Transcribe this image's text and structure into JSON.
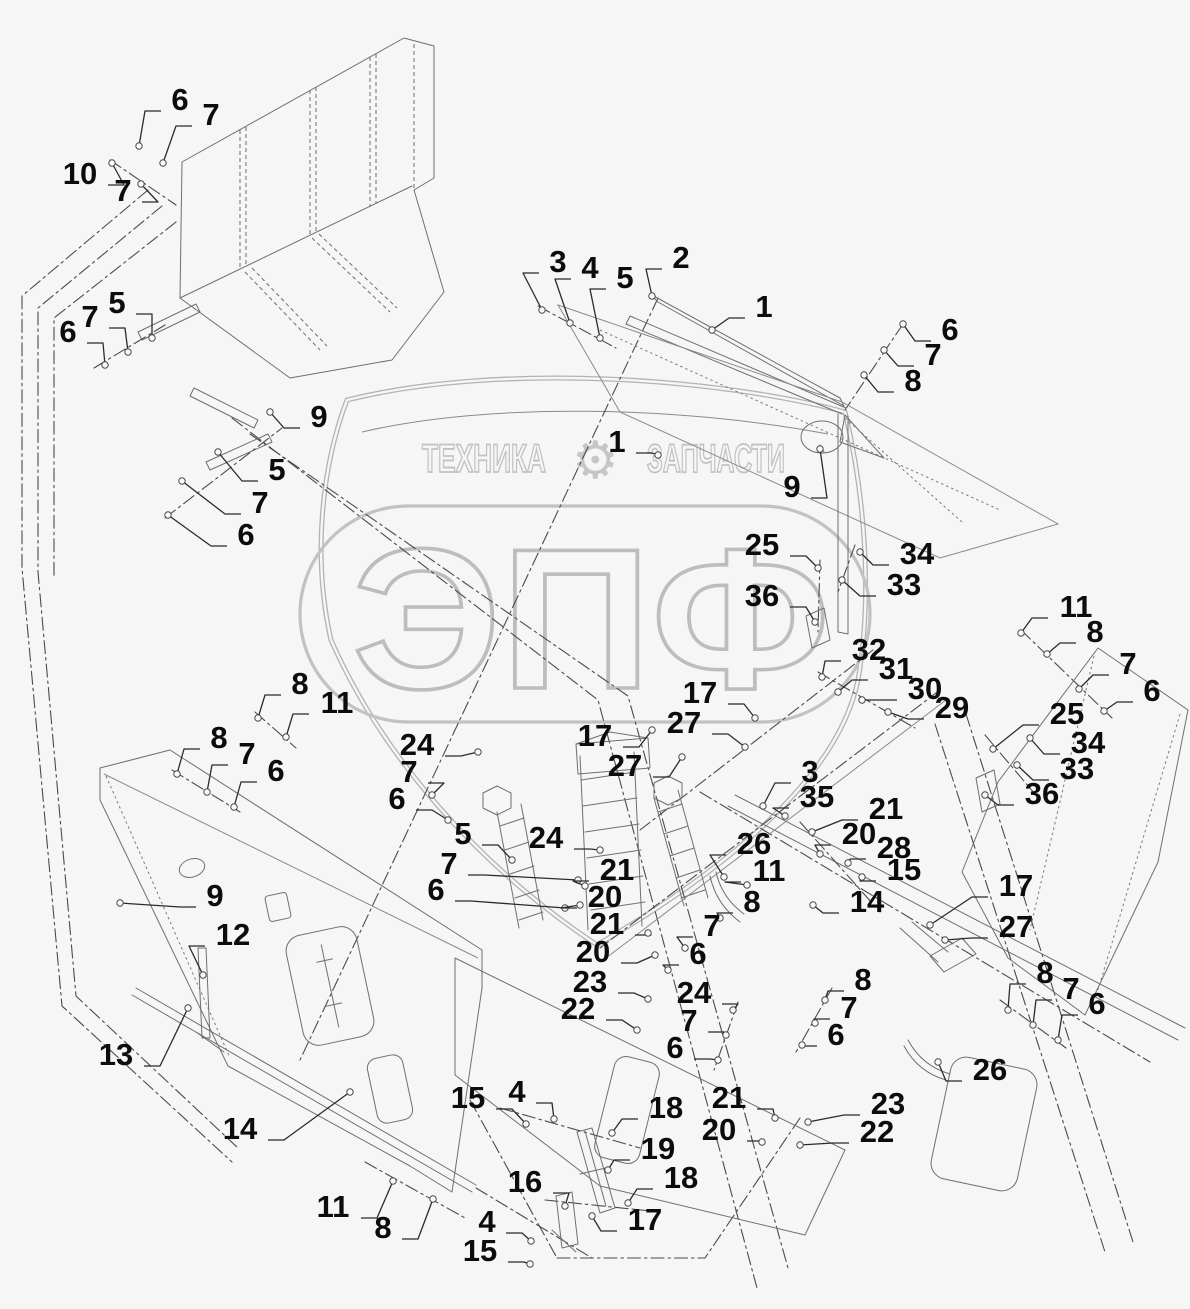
{
  "watermark": {
    "brand_left": "ТЕХНИКА",
    "brand_right": "ЗАПЧАСТИ",
    "gear_icon": "⚙",
    "logo": "ЭПФ",
    "color": "#c2c2c2"
  },
  "colors": {
    "background": "#f6f6f6",
    "line_art": "#6f6f6f",
    "phantom_lines": "#4b4b4b",
    "callout_text": "#0c0c0c",
    "shroud_gray": "#b3b3b3"
  },
  "diagram": {
    "type": "exploded-parts-diagram",
    "part_numbers_shown": [
      "1",
      "2",
      "3",
      "4",
      "5",
      "6",
      "7",
      "8",
      "9",
      "10",
      "11",
      "12",
      "13",
      "14",
      "15",
      "16",
      "17",
      "18",
      "19",
      "20",
      "21",
      "22",
      "23",
      "24",
      "25",
      "26",
      "27",
      "28",
      "29",
      "30",
      "31",
      "32",
      "33",
      "34",
      "35",
      "36"
    ],
    "callouts": [
      {
        "n": "6",
        "x": 180,
        "y": 99,
        "tx": 139,
        "ty": 146
      },
      {
        "n": "7",
        "x": 211,
        "y": 114,
        "tx": 163,
        "ty": 163
      },
      {
        "n": "10",
        "x": 80,
        "y": 173,
        "tx": 112,
        "ty": 163
      },
      {
        "n": "7",
        "x": 123,
        "y": 190,
        "tx": 141,
        "ty": 184
      },
      {
        "n": "6",
        "x": 68,
        "y": 331,
        "tx": 105,
        "ty": 365
      },
      {
        "n": "7",
        "x": 90,
        "y": 316,
        "tx": 128,
        "ty": 352
      },
      {
        "n": "5",
        "x": 117,
        "y": 302,
        "tx": 152,
        "ty": 338
      },
      {
        "n": "9",
        "x": 319,
        "y": 416,
        "tx": 270,
        "ty": 412
      },
      {
        "n": "5",
        "x": 277,
        "y": 469,
        "tx": 218,
        "ty": 452
      },
      {
        "n": "7",
        "x": 260,
        "y": 502,
        "tx": 182,
        "ty": 481
      },
      {
        "n": "6",
        "x": 246,
        "y": 534,
        "tx": 168,
        "ty": 515
      },
      {
        "n": "3",
        "x": 558,
        "y": 261,
        "tx": 542,
        "ty": 310
      },
      {
        "n": "4",
        "x": 590,
        "y": 267,
        "tx": 570,
        "ty": 323
      },
      {
        "n": "5",
        "x": 625,
        "y": 277,
        "tx": 600,
        "ty": 338
      },
      {
        "n": "2",
        "x": 681,
        "y": 257,
        "tx": 652,
        "ty": 296
      },
      {
        "n": "1",
        "x": 764,
        "y": 306,
        "tx": 712,
        "ty": 330
      },
      {
        "n": "1",
        "x": 617,
        "y": 441,
        "tx": 658,
        "ty": 455
      },
      {
        "n": "9",
        "x": 792,
        "y": 486,
        "tx": 820,
        "ty": 449
      },
      {
        "n": "6",
        "x": 950,
        "y": 329,
        "tx": 903,
        "ty": 324
      },
      {
        "n": "7",
        "x": 933,
        "y": 354,
        "tx": 884,
        "ty": 350
      },
      {
        "n": "8",
        "x": 913,
        "y": 380,
        "tx": 864,
        "ty": 375
      },
      {
        "n": "25",
        "x": 762,
        "y": 544,
        "tx": 818,
        "ty": 568
      },
      {
        "n": "34",
        "x": 917,
        "y": 553,
        "tx": 860,
        "ty": 552
      },
      {
        "n": "33",
        "x": 904,
        "y": 584,
        "tx": 842,
        "ty": 580
      },
      {
        "n": "36",
        "x": 762,
        "y": 595,
        "tx": 815,
        "ty": 622
      },
      {
        "n": "32",
        "x": 869,
        "y": 649,
        "tx": 822,
        "ty": 677
      },
      {
        "n": "31",
        "x": 896,
        "y": 668,
        "tx": 838,
        "ty": 692
      },
      {
        "n": "30",
        "x": 925,
        "y": 688,
        "tx": 862,
        "ty": 700
      },
      {
        "n": "29",
        "x": 952,
        "y": 707,
        "tx": 888,
        "ty": 712
      },
      {
        "n": "11",
        "x": 1076,
        "y": 606,
        "tx": 1021,
        "ty": 633
      },
      {
        "n": "8",
        "x": 1095,
        "y": 631,
        "tx": 1047,
        "ty": 654
      },
      {
        "n": "7",
        "x": 1128,
        "y": 663,
        "tx": 1079,
        "ty": 689
      },
      {
        "n": "6",
        "x": 1152,
        "y": 690,
        "tx": 1104,
        "ty": 711
      },
      {
        "n": "17",
        "x": 700,
        "y": 692,
        "tx": 755,
        "ty": 718
      },
      {
        "n": "27",
        "x": 684,
        "y": 722,
        "tx": 745,
        "ty": 747
      },
      {
        "n": "17",
        "x": 595,
        "y": 735,
        "tx": 652,
        "ty": 730
      },
      {
        "n": "27",
        "x": 625,
        "y": 765,
        "tx": 682,
        "ty": 757
      },
      {
        "n": "24",
        "x": 417,
        "y": 744,
        "tx": 478,
        "ty": 752
      },
      {
        "n": "7",
        "x": 409,
        "y": 771,
        "tx": 432,
        "ty": 795
      },
      {
        "n": "6",
        "x": 397,
        "y": 798,
        "tx": 448,
        "ty": 820
      },
      {
        "n": "3",
        "x": 810,
        "y": 771,
        "tx": 763,
        "ty": 806
      },
      {
        "n": "35",
        "x": 817,
        "y": 796,
        "tx": 785,
        "ty": 816
      },
      {
        "n": "21",
        "x": 886,
        "y": 808,
        "tx": 812,
        "ty": 832
      },
      {
        "n": "20",
        "x": 859,
        "y": 833,
        "tx": 820,
        "ty": 854
      },
      {
        "n": "28",
        "x": 894,
        "y": 847,
        "tx": 848,
        "ty": 863
      },
      {
        "n": "15",
        "x": 904,
        "y": 869,
        "tx": 862,
        "ty": 877
      },
      {
        "n": "5",
        "x": 463,
        "y": 833,
        "tx": 512,
        "ty": 860
      },
      {
        "n": "7",
        "x": 449,
        "y": 863,
        "tx": 578,
        "ty": 880
      },
      {
        "n": "6",
        "x": 436,
        "y": 889,
        "tx": 565,
        "ty": 908
      },
      {
        "n": "24",
        "x": 546,
        "y": 837,
        "tx": 600,
        "ty": 850
      },
      {
        "n": "26",
        "x": 754,
        "y": 843,
        "tx": 724,
        "ty": 877
      },
      {
        "n": "11",
        "x": 769,
        "y": 870,
        "tx": 747,
        "ty": 885
      },
      {
        "n": "8",
        "x": 752,
        "y": 901,
        "tx": 720,
        "ty": 918
      },
      {
        "n": "14",
        "x": 867,
        "y": 901,
        "tx": 813,
        "ty": 905
      },
      {
        "n": "21",
        "x": 617,
        "y": 869,
        "tx": 585,
        "ty": 886
      },
      {
        "n": "20",
        "x": 605,
        "y": 896,
        "tx": 580,
        "ty": 905
      },
      {
        "n": "21",
        "x": 607,
        "y": 923,
        "tx": 648,
        "ty": 933
      },
      {
        "n": "20",
        "x": 593,
        "y": 951,
        "tx": 655,
        "ty": 955
      },
      {
        "n": "23",
        "x": 590,
        "y": 981,
        "tx": 648,
        "ty": 999
      },
      {
        "n": "22",
        "x": 578,
        "y": 1008,
        "tx": 637,
        "ty": 1030
      },
      {
        "n": "7",
        "x": 712,
        "y": 925,
        "tx": 685,
        "ty": 948
      },
      {
        "n": "6",
        "x": 698,
        "y": 953,
        "tx": 668,
        "ty": 970
      },
      {
        "n": "24",
        "x": 694,
        "y": 992,
        "tx": 733,
        "ty": 1010
      },
      {
        "n": "7",
        "x": 689,
        "y": 1020,
        "tx": 726,
        "ty": 1035
      },
      {
        "n": "6",
        "x": 675,
        "y": 1047,
        "tx": 718,
        "ty": 1060
      },
      {
        "n": "8",
        "x": 863,
        "y": 979,
        "tx": 825,
        "ty": 1000
      },
      {
        "n": "7",
        "x": 849,
        "y": 1007,
        "tx": 815,
        "ty": 1023
      },
      {
        "n": "6",
        "x": 836,
        "y": 1034,
        "tx": 802,
        "ty": 1045
      },
      {
        "n": "17",
        "x": 1016,
        "y": 885,
        "tx": 930,
        "ty": 925
      },
      {
        "n": "27",
        "x": 1016,
        "y": 926,
        "tx": 945,
        "ty": 940
      },
      {
        "n": "8",
        "x": 1045,
        "y": 972,
        "tx": 1008,
        "ty": 1010
      },
      {
        "n": "7",
        "x": 1071,
        "y": 988,
        "tx": 1033,
        "ty": 1025
      },
      {
        "n": "6",
        "x": 1097,
        "y": 1003,
        "tx": 1058,
        "ty": 1040
      },
      {
        "n": "26",
        "x": 990,
        "y": 1069,
        "tx": 938,
        "ty": 1062
      },
      {
        "n": "23",
        "x": 888,
        "y": 1103,
        "tx": 808,
        "ty": 1122
      },
      {
        "n": "22",
        "x": 877,
        "y": 1131,
        "tx": 800,
        "ty": 1145
      },
      {
        "n": "21",
        "x": 729,
        "y": 1097,
        "tx": 775,
        "ty": 1118
      },
      {
        "n": "20",
        "x": 719,
        "y": 1129,
        "tx": 762,
        "ty": 1142
      },
      {
        "n": "8",
        "x": 300,
        "y": 683,
        "tx": 258,
        "ty": 718
      },
      {
        "n": "11",
        "x": 337,
        "y": 702,
        "tx": 286,
        "ty": 737
      },
      {
        "n": "8",
        "x": 219,
        "y": 737,
        "tx": 177,
        "ty": 774
      },
      {
        "n": "7",
        "x": 247,
        "y": 753,
        "tx": 207,
        "ty": 792
      },
      {
        "n": "6",
        "x": 276,
        "y": 770,
        "tx": 234,
        "ty": 807
      },
      {
        "n": "9",
        "x": 215,
        "y": 895,
        "tx": 120,
        "ty": 903
      },
      {
        "n": "12",
        "x": 233,
        "y": 934,
        "tx": 203,
        "ty": 975
      },
      {
        "n": "13",
        "x": 116,
        "y": 1054,
        "tx": 188,
        "ty": 1008
      },
      {
        "n": "14",
        "x": 240,
        "y": 1128,
        "tx": 350,
        "ty": 1092
      },
      {
        "n": "11",
        "x": 333,
        "y": 1206,
        "tx": 393,
        "ty": 1181
      },
      {
        "n": "8",
        "x": 383,
        "y": 1227,
        "tx": 433,
        "ty": 1199
      },
      {
        "n": "15",
        "x": 468,
        "y": 1097,
        "tx": 526,
        "ty": 1124
      },
      {
        "n": "4",
        "x": 517,
        "y": 1091,
        "tx": 554,
        "ty": 1119
      },
      {
        "n": "18",
        "x": 666,
        "y": 1107,
        "tx": 612,
        "ty": 1133
      },
      {
        "n": "19",
        "x": 658,
        "y": 1148,
        "tx": 608,
        "ty": 1170
      },
      {
        "n": "18",
        "x": 681,
        "y": 1177,
        "tx": 628,
        "ty": 1203
      },
      {
        "n": "16",
        "x": 525,
        "y": 1181,
        "tx": 565,
        "ty": 1206
      },
      {
        "n": "17",
        "x": 645,
        "y": 1219,
        "tx": 592,
        "ty": 1216
      },
      {
        "n": "4",
        "x": 487,
        "y": 1221,
        "tx": 531,
        "ty": 1241
      },
      {
        "n": "15",
        "x": 480,
        "y": 1250,
        "tx": 530,
        "ty": 1264
      },
      {
        "n": "25",
        "x": 1067,
        "y": 713,
        "tx": 993,
        "ty": 749
      },
      {
        "n": "34",
        "x": 1088,
        "y": 742,
        "tx": 1030,
        "ty": 738
      },
      {
        "n": "33",
        "x": 1077,
        "y": 768,
        "tx": 1017,
        "ty": 765
      },
      {
        "n": "36",
        "x": 1042,
        "y": 793,
        "tx": 985,
        "ty": 795
      }
    ]
  }
}
